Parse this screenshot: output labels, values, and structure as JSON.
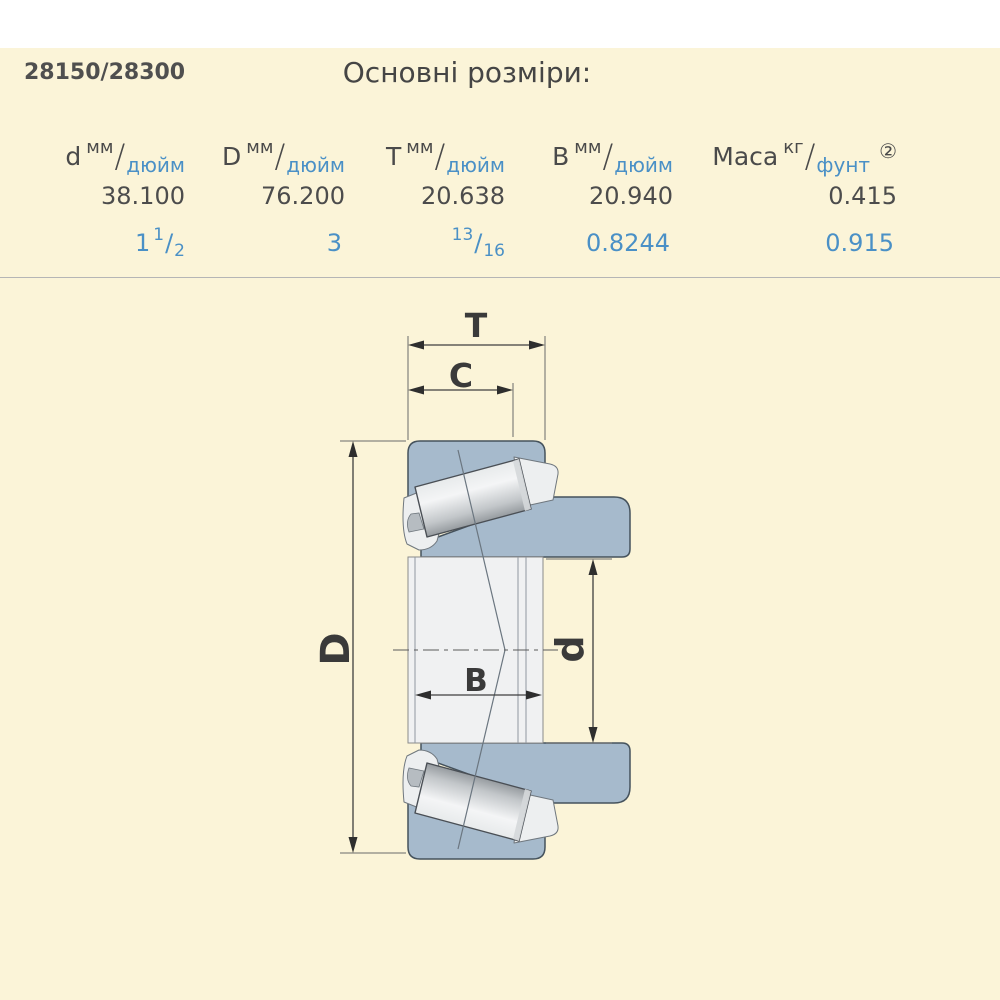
{
  "header": {
    "part_number": "28150/28300",
    "title": "Основні розміри:"
  },
  "table": {
    "frac_slash": "/",
    "columns": [
      {
        "symbol": "d",
        "unit_top": "мм",
        "unit_bottom": "дюйм",
        "note": ""
      },
      {
        "symbol": "D",
        "unit_top": "мм",
        "unit_bottom": "дюйм",
        "note": ""
      },
      {
        "symbol": "T",
        "unit_top": "мм",
        "unit_bottom": "дюйм",
        "note": ""
      },
      {
        "symbol": "B",
        "unit_top": "мм",
        "unit_bottom": "дюйм",
        "note": ""
      },
      {
        "symbol": "Маса",
        "unit_top": "кг",
        "unit_bottom": "фунт",
        "note": "②"
      }
    ],
    "metric_values": [
      "38.100",
      "76.200",
      "20.638",
      "20.940",
      "0.415"
    ],
    "inch_values": [
      {
        "whole": "1",
        "num": "1",
        "slash": "/",
        "den": "2"
      },
      {
        "whole": "3",
        "num": "",
        "slash": "",
        "den": ""
      },
      {
        "whole": "",
        "num": "13",
        "slash": "/",
        "den": "16"
      },
      {
        "whole": "0.8244",
        "num": "",
        "slash": "",
        "den": ""
      },
      {
        "whole": "0.915",
        "num": "",
        "slash": "",
        "den": ""
      }
    ]
  },
  "drawing": {
    "dim_labels": {
      "T": "T",
      "C": "C",
      "D": "D",
      "d": "d",
      "B": "B"
    }
  },
  "theme": {
    "page_bg": "#FBF4D8",
    "top_strip": "#FFFFFF",
    "text_dark": "#4A4A4A",
    "text_blue": "#4A90C6",
    "separator": "#B5B5B5",
    "ring_fill": "#A6BACC",
    "ring_stroke": "#45525C",
    "dim_color": "#3F3F3F",
    "cage_fill": "#EDEFF0",
    "bore_fill": "#F0F1F2"
  }
}
